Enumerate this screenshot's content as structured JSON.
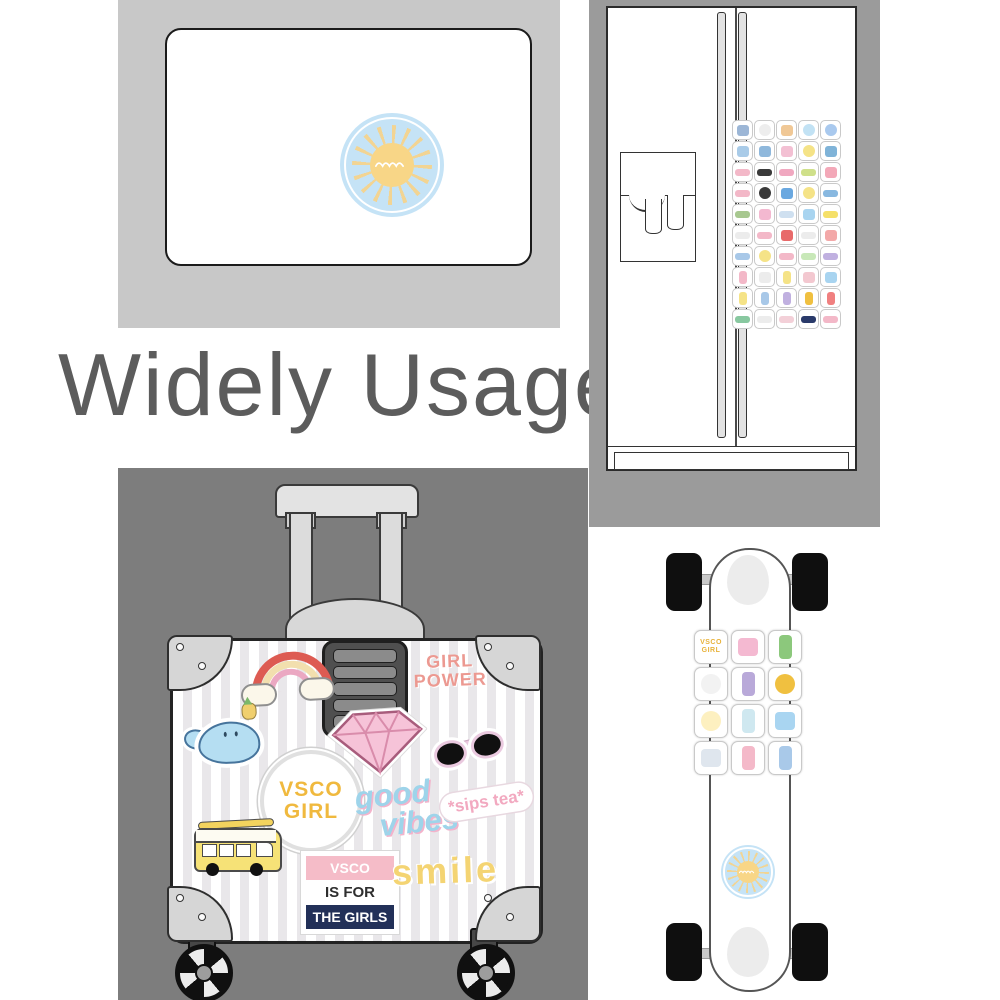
{
  "title": {
    "text": "Widely Usage"
  },
  "palette": {
    "laptop_panel": "#c8c8c8",
    "fridge_panel": "#9b9b9b",
    "suitcase_panel": "#7d7d7d",
    "title_color": "#5c5c5c",
    "sun_sticker_blue": "#c5e3f6",
    "sun_sticker_yellow": "#f8d687",
    "band_pink": "#f5bcc8",
    "band_navy": "#223058"
  },
  "laptop": {
    "sticker": "sun-with-wave"
  },
  "fridge": {
    "stickers": [
      {
        "name": "jeep",
        "color": "#9cb6d6",
        "shape": "square"
      },
      {
        "name": "wave-circle",
        "color": "#ededed",
        "shape": "circle"
      },
      {
        "name": "polaroid",
        "color": "#f0c896",
        "shape": "square"
      },
      {
        "name": "sun-circle",
        "color": "#c2e2f4",
        "shape": "circle"
      },
      {
        "name": "donut",
        "color": "#a9c9ee",
        "shape": "circle"
      },
      {
        "name": "camera",
        "color": "#a9cbe8",
        "shape": "square"
      },
      {
        "name": "bird",
        "color": "#8fb8dc",
        "shape": "square"
      },
      {
        "name": "diamond",
        "color": "#f3c0d3",
        "shape": "square"
      },
      {
        "name": "daisy-sun",
        "color": "#f5e387",
        "shape": "circle"
      },
      {
        "name": "sea-turtle",
        "color": "#7fb3d8",
        "shape": "square"
      },
      {
        "name": "vsco-girls-text",
        "color": "#f3b8c8",
        "shape": "wide"
      },
      {
        "name": "sunglasses",
        "color": "#3a3a3a",
        "shape": "wide"
      },
      {
        "name": "text-collage",
        "color": "#f0a8c0",
        "shape": "wide"
      },
      {
        "name": "lime-text",
        "color": "#cfe08a",
        "shape": "wide"
      },
      {
        "name": "watermelon",
        "color": "#f3a8b8",
        "shape": "square"
      },
      {
        "name": "happy-text",
        "color": "#f3b8c8",
        "shape": "wide"
      },
      {
        "name": "eye-lashes",
        "color": "#3a3a3a",
        "shape": "circle"
      },
      {
        "name": "butterfly",
        "color": "#6aa8e0",
        "shape": "square"
      },
      {
        "name": "lemon-half",
        "color": "#f5e387",
        "shape": "circle"
      },
      {
        "name": "vans-wave",
        "color": "#88b8e0",
        "shape": "wide"
      },
      {
        "name": "sandal",
        "color": "#a8c890",
        "shape": "wide"
      },
      {
        "name": "backpack",
        "color": "#f3b8d0",
        "shape": "square"
      },
      {
        "name": "sneaker",
        "color": "#cfe0f0",
        "shape": "wide"
      },
      {
        "name": "whale",
        "color": "#a8d4f0",
        "shape": "square"
      },
      {
        "name": "camper-bus",
        "color": "#f5e069",
        "shape": "wide"
      },
      {
        "name": "speech-text",
        "color": "#ececec",
        "shape": "wide"
      },
      {
        "name": "tubular-text",
        "color": "#f3b8c8",
        "shape": "wide"
      },
      {
        "name": "rainbow",
        "color": "#e86a6a",
        "shape": "square"
      },
      {
        "name": "script-text",
        "color": "#ececec",
        "shape": "wide"
      },
      {
        "name": "fries",
        "color": "#f3a8a8",
        "shape": "square"
      },
      {
        "name": "wave-text",
        "color": "#a8c8e8",
        "shape": "wide"
      },
      {
        "name": "egg",
        "color": "#f5e387",
        "shape": "circle"
      },
      {
        "name": "pink-text",
        "color": "#f3b8c8",
        "shape": "wide"
      },
      {
        "name": "green-text",
        "color": "#c8e8b8",
        "shape": "wide"
      },
      {
        "name": "vsco-text",
        "color": "#c0b0e0",
        "shape": "wide"
      },
      {
        "name": "boba-drink",
        "color": "#f3b8c8",
        "shape": "tall"
      },
      {
        "name": "peace-hand",
        "color": "#ececec",
        "shape": "square"
      },
      {
        "name": "lemonade",
        "color": "#f5e387",
        "shape": "tall"
      },
      {
        "name": "dog",
        "color": "#f3c8d0",
        "shape": "square"
      },
      {
        "name": "jellyfish",
        "color": "#a8d4f0",
        "shape": "square"
      },
      {
        "name": "pineapple",
        "color": "#f5e387",
        "shape": "tall"
      },
      {
        "name": "blue-bottle",
        "color": "#a8c8e8",
        "shape": "tall"
      },
      {
        "name": "purple-bottle",
        "color": "#c0b0e0",
        "shape": "tall"
      },
      {
        "name": "sunflower-jar",
        "color": "#f0c040",
        "shape": "tall"
      },
      {
        "name": "toothpaste",
        "color": "#f08080",
        "shape": "tall"
      },
      {
        "name": "skateboard",
        "color": "#88c8a0",
        "shape": "wide"
      },
      {
        "name": "white-text",
        "color": "#ececec",
        "shape": "wide"
      },
      {
        "name": "pink-text-2",
        "color": "#f3d0d8",
        "shape": "wide"
      },
      {
        "name": "navy-text",
        "color": "#2a3a6a",
        "shape": "wide"
      },
      {
        "name": "pink-text-3",
        "color": "#f3b8c8",
        "shape": "wide"
      }
    ]
  },
  "suitcase": {
    "stickers": {
      "girl_power_line1": "GIRL",
      "girl_power_line2": "POWER",
      "vsco_circle_line1": "VSCO",
      "vsco_circle_line2": "GIRL",
      "good_vibes_line1": "good",
      "good_vibes_line2": "vibes",
      "sips_tea": "*sips tea*",
      "vsco_band_1": "VSCO",
      "vsco_band_2": "IS FOR",
      "vsco_band_3": "THE GIRLS",
      "smile": "smile"
    }
  },
  "skateboard": {
    "stickers": [
      {
        "name": "vsco-girl-circle",
        "color": "#ffffff",
        "shape": "circle",
        "label": "VSCO\nGIRL"
      },
      {
        "name": "backpack",
        "color": "#f4b9d1",
        "shape": "square"
      },
      {
        "name": "cactus-pot",
        "color": "#8cc87c",
        "shape": "tall"
      },
      {
        "name": "wave-circle",
        "color": "#f2f2f2",
        "shape": "circle"
      },
      {
        "name": "purple-bottle",
        "color": "#b9a9d9",
        "shape": "tall"
      },
      {
        "name": "sunflower",
        "color": "#f0c040",
        "shape": "circle"
      },
      {
        "name": "daisy",
        "color": "#fdf0c0",
        "shape": "circle"
      },
      {
        "name": "plant-jar",
        "color": "#cfe8f0",
        "shape": "tall"
      },
      {
        "name": "jellyfish",
        "color": "#a9d5f1",
        "shape": "square"
      },
      {
        "name": "jeep",
        "color": "#dfe6ee",
        "shape": "square"
      },
      {
        "name": "pink-drink",
        "color": "#f4b9c9",
        "shape": "tall"
      },
      {
        "name": "blue-bottle",
        "color": "#a9c9e9",
        "shape": "tall"
      }
    ]
  }
}
